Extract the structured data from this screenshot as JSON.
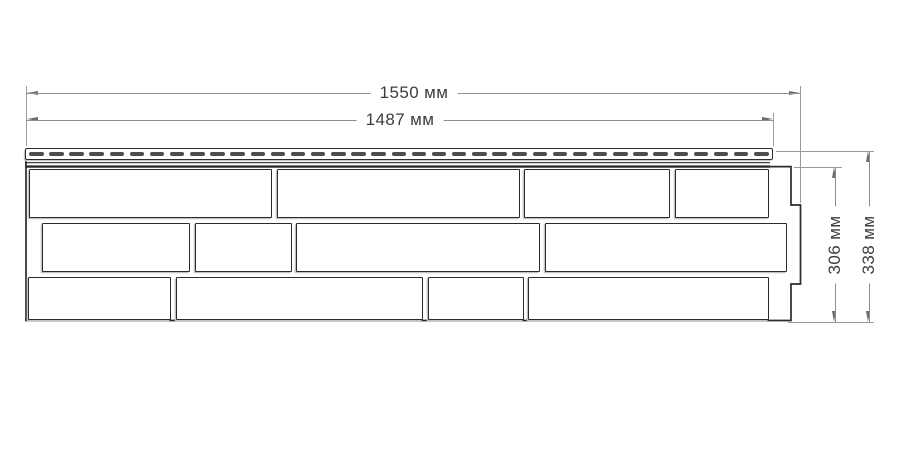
{
  "diagram": {
    "dimensions": {
      "overall_width": {
        "label": "1550 мм",
        "value": 1550,
        "unit": "мм"
      },
      "nail_hem_width": {
        "label": "1487 мм",
        "value": 1487,
        "unit": "мм"
      },
      "body_height": {
        "label": "306 мм",
        "value": 306,
        "unit": "мм"
      },
      "overall_height": {
        "label": "338 мм",
        "value": 338,
        "unit": "мм"
      }
    },
    "colors": {
      "background": "#ffffff",
      "outline": "#2b2b2b",
      "slot_fill": "#4d4d4d",
      "dimension_line": "#8f8f8f",
      "arrow": "#6b6b6b",
      "label_text": "#3d3d3d"
    },
    "panel": {
      "nail_strip": {
        "slot_count": 37
      },
      "brick_rows": [
        {
          "y": 169,
          "h": 49,
          "bricks": [
            [
              29,
              243
            ],
            [
              277,
              243
            ],
            [
              524,
              146
            ],
            [
              675,
              94
            ]
          ]
        },
        {
          "y": 223,
          "h": 49,
          "bricks": [
            [
              42,
              148
            ],
            [
              195,
              97
            ],
            [
              296,
              244
            ],
            [
              545,
              242
            ]
          ]
        },
        {
          "y": 277,
          "h": 43,
          "bricks": [
            [
              28,
              143
            ],
            [
              176,
              247
            ],
            [
              428,
              96
            ],
            [
              528,
              241
            ]
          ]
        }
      ]
    }
  }
}
